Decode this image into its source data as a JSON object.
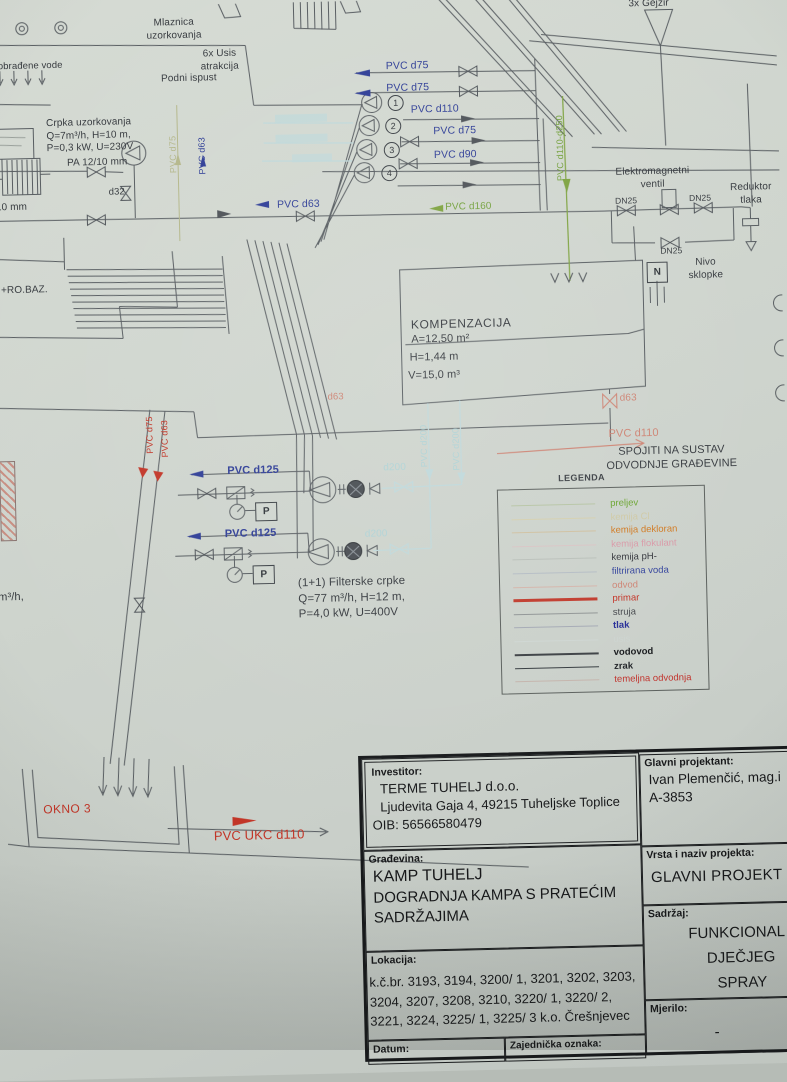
{
  "colors": {
    "paper": "#cfd5ce",
    "ink": "#3c4146",
    "blue": "#2e3d96",
    "red": "#c23527",
    "green": "#73a03c",
    "cyan": "#aed2d5",
    "salmon": "#cd8272",
    "olive": "#b4b78a"
  },
  "top": {
    "obradene": "a obrađene vode",
    "mlaznica": "Mlaznica\nuzorkovanja",
    "usis": "6x Usis\natrakcija",
    "podni": "Podni ispust",
    "gejzir": "3x Gejzir",
    "crpka": "Crpka uzorkovanja\nQ=7m³/h, H=10 m,\nP=0,3 kW, U=230V",
    "pa": "PA 12/10 mm",
    "d32": "d32",
    "mm10": "/10 mm",
    "pvc_d63_h": "PVC d63",
    "pvc_d63_v": "PVC d63",
    "pvc_d75_v": "PVC d75",
    "lines": [
      "PVC d75",
      "PVC d75",
      "PVC d110",
      "PVC d75",
      "PVC d90"
    ],
    "circles": [
      "1",
      "2",
      "3",
      "4"
    ],
    "pvc_d160": "PVC d160",
    "pvc_d110_250": "PVC d110-d250",
    "elektro": "Elektromagnetni\nventil",
    "dn25": "DN25",
    "reduktor": "Reduktor\ntlaka",
    "nivo": "Nivo\nsklopke",
    "n_box": "N"
  },
  "mid": {
    "ro_baz": "+RO.BAZ.",
    "komp_title": "KOMPENZACIJA",
    "komp_a": "A=12,50 m²",
    "komp_h": "H=1,44 m",
    "komp_v": "V=15,0 m³",
    "d63_tank": "d63",
    "pvc_d110_odvod": "PVC d110",
    "spojiti": "SPOJITI NA SUSTAV\nODVODNJE GRAĐEVINE",
    "d63_red": "d63",
    "pvc_d75_red": "PVC d75",
    "pvc_d63_red": "PVC d63",
    "d200_a": "d200",
    "d200_b": "d200",
    "pvc_d200_v1": "PVC d200",
    "pvc_d200_v2": "PVC d200",
    "pvc_d125_a": "PVC d125",
    "pvc_d125_b": "PVC d125",
    "p_box": "P",
    "filterske": "(1+1) Filterske crpke\nQ=77 m³/h, H=12 m,\nP=4,0 kW, U=400V",
    "m3h_frag": "m³/h,"
  },
  "legend": {
    "title": "LEGENDA",
    "entries": [
      {
        "label": "preljev",
        "color": "#69a42e",
        "line": "#b6c4a4",
        "lw": 1,
        "bold": false
      },
      {
        "label": "kemija Cl",
        "color": "#cfc9a4",
        "line": "#d4cfae",
        "lw": 1,
        "bold": false
      },
      {
        "label": "kemija dekloran",
        "color": "#d0781f",
        "line": "#cfc0a0",
        "lw": 1,
        "bold": false
      },
      {
        "label": "kemija flokulant",
        "color": "#d898a6",
        "line": "#d8c4c4",
        "lw": 1,
        "bold": false
      },
      {
        "label": "kemija pH-",
        "color": "#303239",
        "line": "#b9bfb9",
        "lw": 1,
        "bold": false
      },
      {
        "label": "filtrirana voda",
        "color": "#31419b",
        "line": "#b4bcc4",
        "lw": 1,
        "bold": false
      },
      {
        "label": "odvod",
        "color": "#cd8272",
        "line": "#d4b4aa",
        "lw": 1,
        "bold": false
      },
      {
        "label": "primar",
        "color": "#c23023",
        "line": "#c0392b",
        "lw": 2.5,
        "bold": false
      },
      {
        "label": "struja",
        "color": "#43464b",
        "line": "#8f9494",
        "lw": 1,
        "bold": false
      },
      {
        "label": "tlak",
        "color": "#232a96",
        "line": "#a4a9b4",
        "lw": 1,
        "bold": true
      },
      {
        "label": "usis",
        "color": "#ccd4d0",
        "line": "#ced6d2",
        "lw": 1,
        "bold": false
      },
      {
        "label": "vodovod",
        "color": "#141619",
        "line": "#3c4044",
        "lw": 1.6,
        "bold": true
      },
      {
        "label": "zrak",
        "color": "#1d2024",
        "line": "#343a3e",
        "lw": 1.4,
        "bold": true
      },
      {
        "label": "temeljna odvodnja",
        "color": "#c0302a",
        "line": "#c4b4ac",
        "lw": 1,
        "bold": false
      }
    ]
  },
  "bottom": {
    "okno": "OKNO 3",
    "pvc_ukc": "PVC UKC d110"
  },
  "titleblock": {
    "investitor_label": "Investitor:",
    "investitor_name": "TERME TUHELJ d.o.o.",
    "investitor_addr": "Ljudevita Gaja 4, 49215 Tuheljske Toplice",
    "investitor_oib": "OIB: 56566580479",
    "gradevina_label": "Građevina:",
    "gradevina_line1": "KAMP TUHELJ",
    "gradevina_line2": "DOGRADNJA KAMPA S PRATEĆIM",
    "gradevina_line3": "SADRŽAJIMA",
    "lokacija_label": "Lokacija:",
    "lokacija_text": "k.č.br. 3193, 3194, 3200/ 1, 3201, 3202, 3203, 3204, 3207, 3208, 3210, 3220/ 1, 3220/ 2, 3221, 3224, 3225/ 1, 3225/ 3 k.o. Črešnjevec",
    "datum_label": "Datum:",
    "zajednicka_label": "Zajednička oznaka:",
    "projektant_label": "Glavni projektant:",
    "projektant_name": "Ivan Plemenčić, mag.i",
    "projektant_id": "A-3853",
    "vrsta_label": "Vrsta i naziv projekta:",
    "vrsta_value": "GLAVNI PROJEKT",
    "sadrzaj_label": "Sadržaj:",
    "sadrzaj_line1": "FUNKCIONAL",
    "sadrzaj_line2": "DJEČJEG",
    "sadrzaj_line3": "SPRAY",
    "mjerilo_label": "Mjerilo:",
    "mjerilo_value": "-"
  }
}
